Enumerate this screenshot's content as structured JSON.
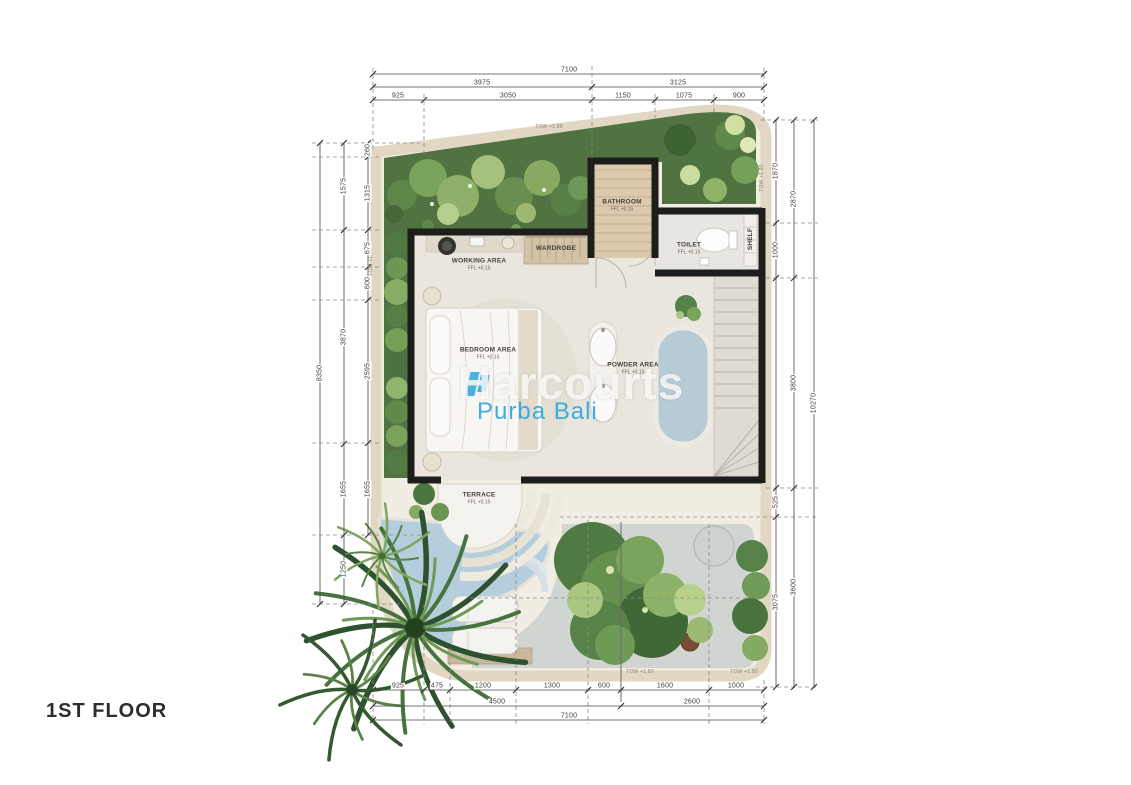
{
  "title": "1ST FLOOR",
  "watermark": {
    "brand": "Harcourts",
    "subtitle": "Purba Bali"
  },
  "wall_note": "TOW +1.90",
  "rooms": {
    "bathroom": {
      "name": "BATHROOM",
      "level": "FFL +0.15"
    },
    "toilet": {
      "name": "TOILET",
      "level": "FFL +0.15"
    },
    "shelf": {
      "name": "SHELF"
    },
    "working": {
      "name": "WORKING AREA",
      "level": "FFL +0.15"
    },
    "wardrobe": {
      "name": "WARDROBE"
    },
    "bedroom": {
      "name": "BEDROOM AREA",
      "level": "FFL +0.15"
    },
    "powder": {
      "name": "POWDER AREA",
      "level": "FFL +0.15"
    },
    "terrace": {
      "name": "TERRACE",
      "level": "FFL +0.15"
    }
  },
  "dimensions_mm": {
    "top": {
      "total": "7100",
      "groups": [
        "3975",
        "3125"
      ],
      "segments": [
        "925",
        "3050",
        "1150",
        "1075",
        "900"
      ]
    },
    "bottom": {
      "segments": [
        "925",
        "475",
        "1200",
        "1300",
        "600",
        "1600",
        "1000"
      ],
      "groups": [
        "4500",
        "2600"
      ],
      "total": "7100"
    },
    "left": {
      "total": "8350",
      "groups": [
        "1575",
        "3870",
        "1655",
        "1250"
      ],
      "segments": [
        "260",
        "1315",
        "675",
        "600",
        "2595",
        "1655"
      ]
    },
    "right": {
      "total": "10270",
      "groups": [
        "2870",
        "3800",
        "3600"
      ],
      "segments": [
        "1870",
        "1000",
        "525",
        "3075"
      ]
    }
  },
  "colors": {
    "accent_blue": "#2ba9df",
    "wall_black": "#1d1d1b",
    "boundary_beige": "#e1d7c3",
    "pool_blue": "#b5cedd",
    "greenery": "#4f7a41"
  }
}
